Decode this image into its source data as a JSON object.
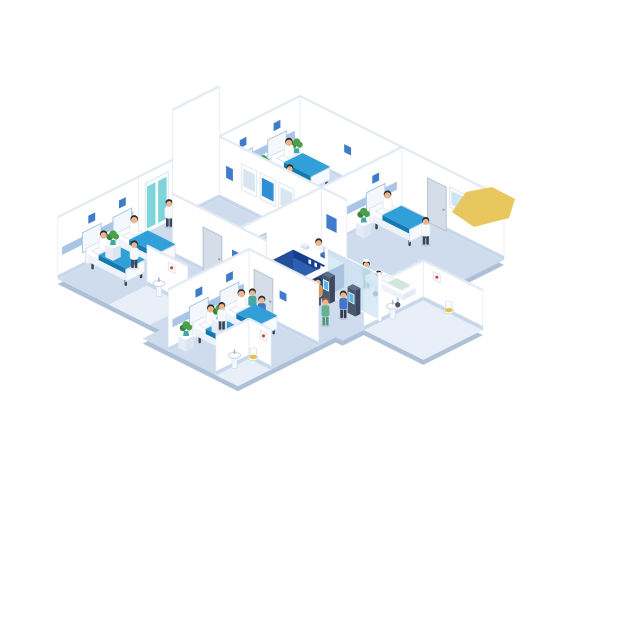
{
  "scene": {
    "alt_text": "Isometric cutaway illustration of a hospital floor with patient wards, imaging room, reception lobby, check-in kiosks, bathrooms, staff and patients",
    "background": "#ffffff",
    "rooms": [
      {
        "name": "ward-top",
        "beds": 2,
        "patients": 2,
        "nurses": 1,
        "plants": 2
      },
      {
        "name": "ward-right",
        "beds": 1,
        "patients": 1,
        "doctors": 1,
        "plants": 1,
        "bathroom_fixtures": [
          "toilet",
          "sink"
        ]
      },
      {
        "name": "imaging-room",
        "xray_viewers": 3,
        "staff": 1,
        "glass_door": true
      },
      {
        "name": "reception-lobby",
        "reception_desk": true,
        "receptionists": 1,
        "check_in_kiosks": 2,
        "kiosk_users": 2,
        "visitors": 2,
        "stretcher_patients": 1,
        "nurses": 2
      },
      {
        "name": "ward-left",
        "beds": 2,
        "patients": 2,
        "nurses": 1,
        "plants": 1,
        "bathroom_fixtures": [
          "sink"
        ]
      },
      {
        "name": "ward-bottom",
        "beds": 2,
        "patients": 2,
        "nurses": 1,
        "plants": 2,
        "bathroom_fixtures": [
          "toilet",
          "sink"
        ]
      }
    ],
    "decor": {
      "highlight_shape": "yellow-polygon"
    },
    "palette": {
      "floor": "#cfdcee",
      "floor_edge": "#aebfd8",
      "bath_floor": "#e9eff8",
      "wall": "#ffffff",
      "wall_line": "#e3eaf3",
      "wall_top": "#e2eaf4",
      "baseboard": "#c7d7ec",
      "rail": "#a9c6e8",
      "rail_panel": "#f4f8fd",
      "sign_blue": "#3f7cc9",
      "blanket": "#31a0d8",
      "blanket_dark": "#1479b0",
      "blanket_side": "#1e8cc4",
      "bed_leg": "#3c424d",
      "desk_front": "#2e5fae",
      "desk_side": "#234e9c",
      "desk_band": "#143f8c",
      "kiosk_screen": "#5ab4e8",
      "glass": "#cfe4f4",
      "door": "#d5dde8",
      "door_edge": "#b8c3d4",
      "glassdoor_teal": "#6fd0d6",
      "screen_blue": "#2e8fd6",
      "screen_light": "#d9e6f2",
      "plant": "#4ba04b",
      "plant_dark": "#3a8440",
      "pot": "#3fa8a2",
      "skin": "#eab68e",
      "hair": "#2e2a28",
      "hair_red": "#b5533c",
      "coat": "#f6f9fc",
      "pants": "#3c4556",
      "scrub": "#63b291",
      "scrub_dark": "#4d9a7b",
      "shirt_orange": "#e78f3c",
      "shirt_blue": "#4477cc",
      "shirt_teal": "#46a8a2",
      "toilet_lid": "#e6c243",
      "art_red": "#cc4b3e",
      "yellow_shape": "#e7c75e",
      "metal": "#c3cedd",
      "shadow": "rgba(90,110,150,0.16)"
    }
  }
}
